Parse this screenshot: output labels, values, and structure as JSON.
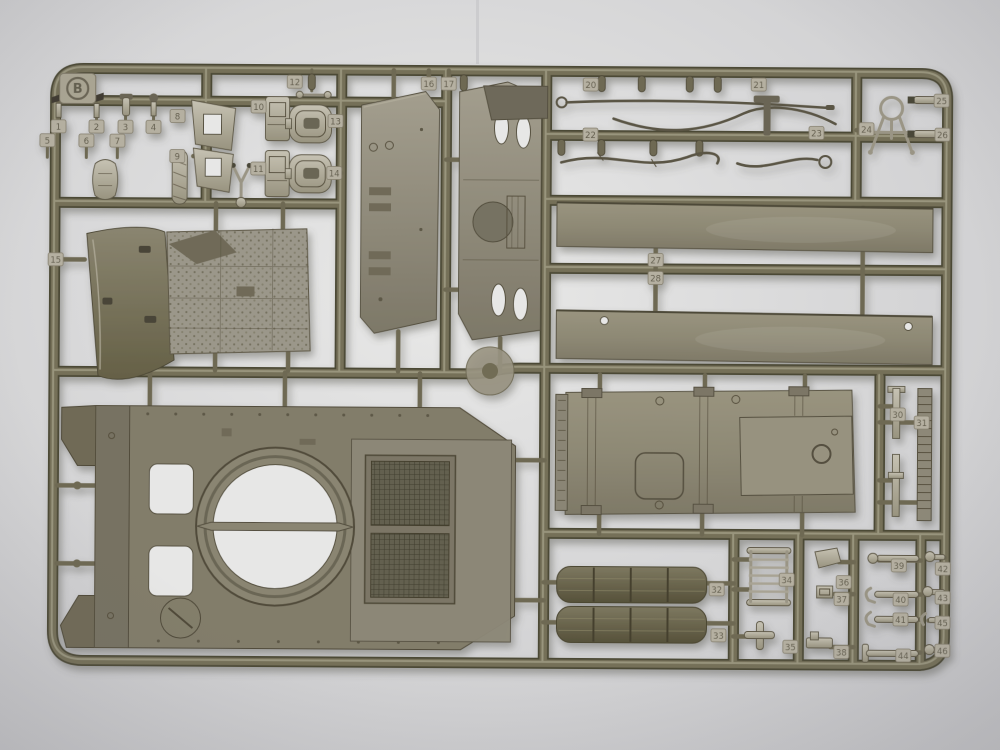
{
  "scene": {
    "frame_letter": "B"
  },
  "colors": {
    "background_center": "#e9e9e8",
    "background_edge": "#c6c6c9",
    "runner_dark": "#4c4836",
    "runner_mid": "#746f58",
    "runner_light": "#a6a189",
    "part_dark": "#5e5947",
    "hole": "#e7e7e6",
    "tag_fill": "#b5b0a1",
    "tag_text": "#645f4f"
  },
  "part_tags": [
    {
      "label": "1",
      "x": 57,
      "y": 129
    },
    {
      "label": "2",
      "x": 95,
      "y": 129
    },
    {
      "label": "3",
      "x": 124,
      "y": 129
    },
    {
      "label": "4",
      "x": 152,
      "y": 129
    },
    {
      "label": "5",
      "x": 46,
      "y": 143
    },
    {
      "label": "6",
      "x": 85,
      "y": 143
    },
    {
      "label": "7",
      "x": 116,
      "y": 143
    },
    {
      "label": "8",
      "x": 176,
      "y": 118
    },
    {
      "label": "9",
      "x": 176,
      "y": 158
    },
    {
      "label": "10",
      "x": 257,
      "y": 108
    },
    {
      "label": "11",
      "x": 257,
      "y": 170
    },
    {
      "label": "12",
      "x": 293,
      "y": 83
    },
    {
      "label": "13",
      "x": 334,
      "y": 122
    },
    {
      "label": "14",
      "x": 333,
      "y": 174
    },
    {
      "label": "15",
      "x": 55,
      "y": 262
    },
    {
      "label": "16",
      "x": 427,
      "y": 84
    },
    {
      "label": "17",
      "x": 447,
      "y": 84
    },
    {
      "label": "20",
      "x": 589,
      "y": 84
    },
    {
      "label": "21",
      "x": 757,
      "y": 83
    },
    {
      "label": "22",
      "x": 589,
      "y": 134
    },
    {
      "label": "23",
      "x": 815,
      "y": 131
    },
    {
      "label": "24",
      "x": 865,
      "y": 127
    },
    {
      "label": "25",
      "x": 940,
      "y": 98
    },
    {
      "label": "26",
      "x": 941,
      "y": 132
    },
    {
      "label": "27",
      "x": 655,
      "y": 259
    },
    {
      "label": "28",
      "x": 655,
      "y": 277
    },
    {
      "label": "30",
      "x": 898,
      "y": 412
    },
    {
      "label": "31",
      "x": 922,
      "y": 420
    },
    {
      "label": "32",
      "x": 718,
      "y": 588
    },
    {
      "label": "33",
      "x": 720,
      "y": 634
    },
    {
      "label": "34",
      "x": 788,
      "y": 578
    },
    {
      "label": "35",
      "x": 792,
      "y": 645
    },
    {
      "label": "36",
      "x": 845,
      "y": 580
    },
    {
      "label": "37",
      "x": 843,
      "y": 597
    },
    {
      "label": "38",
      "x": 843,
      "y": 650
    },
    {
      "label": "39",
      "x": 900,
      "y": 563
    },
    {
      "label": "40",
      "x": 902,
      "y": 597
    },
    {
      "label": "41",
      "x": 902,
      "y": 617
    },
    {
      "label": "42",
      "x": 944,
      "y": 566
    },
    {
      "label": "43",
      "x": 944,
      "y": 595
    },
    {
      "label": "44",
      "x": 905,
      "y": 653
    },
    {
      "label": "45",
      "x": 944,
      "y": 620
    },
    {
      "label": "46",
      "x": 944,
      "y": 648
    }
  ]
}
